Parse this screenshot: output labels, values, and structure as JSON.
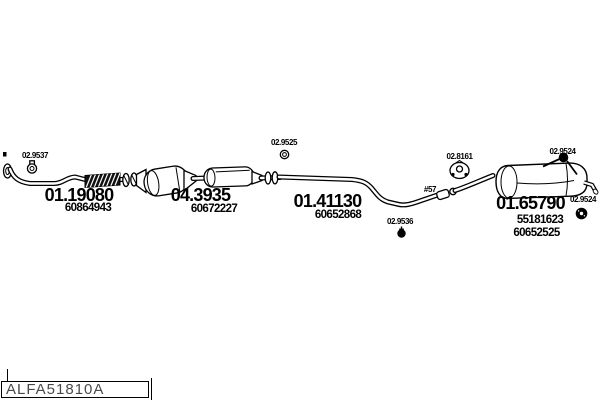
{
  "parts": {
    "front_pipe": {
      "code": "01.19080",
      "oe": "60864943"
    },
    "catalytic_converter": {
      "code": "04.3935",
      "oe": "60672227"
    },
    "center_pipe": {
      "code": "01.41130",
      "oe": "60652868"
    },
    "rear_silencer": {
      "code": "01.65790",
      "oe_1": "55181623",
      "oe_2": "60652525"
    }
  },
  "callouts": {
    "front_clamp": "02.9537",
    "center_ring": "02.9525",
    "center_mount": "02.9536",
    "mid_hanger": "02.8161",
    "rear_hanger_top": "02.9524",
    "rear_hanger_side": "02.9524",
    "ref_marker": "#57"
  },
  "icons": {
    "front_clamp": "pipe-clamp-icon",
    "center_ring": "gasket-ring-icon",
    "center_mount": "rubber-mount-icon",
    "mid_hanger": "rubber-hanger-icon",
    "rear_hanger_top": "ball-hanger-icon",
    "rear_hanger_side": "rubber-grommet-icon"
  },
  "footer": {
    "drawing_code": "ALFA51810A"
  },
  "colors": {
    "ink": "#000000",
    "background": "#ffffff",
    "footer_text": "#4a4a4a"
  }
}
